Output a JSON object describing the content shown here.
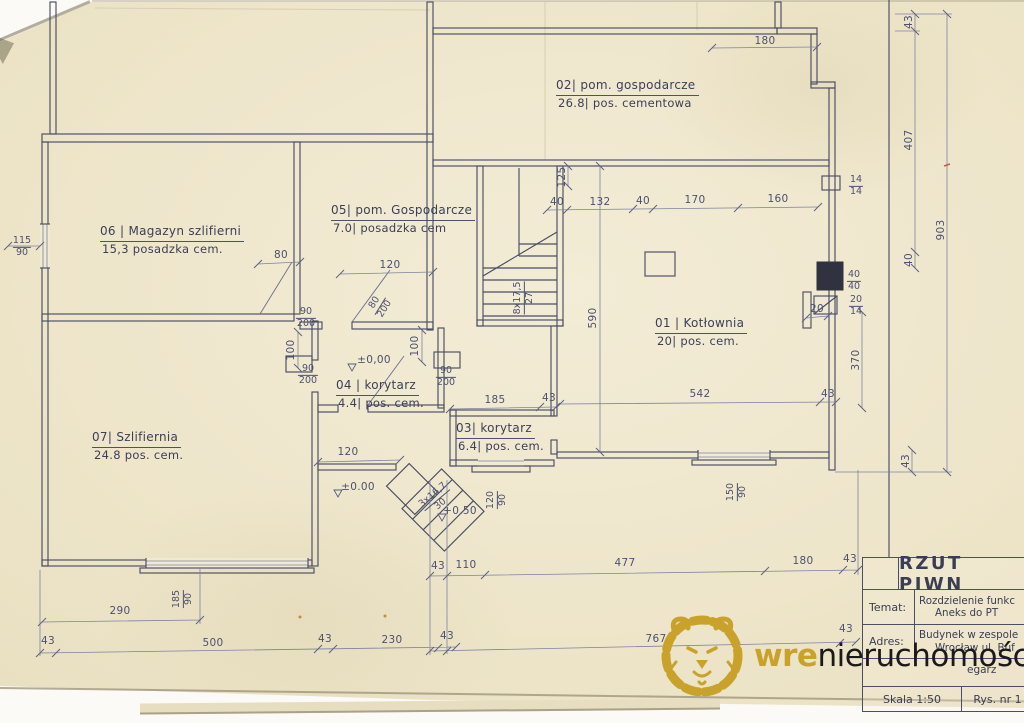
{
  "colors": {
    "paper": "#ece3c6",
    "ink": "#3e4257",
    "dimension_ink": "#4c5170",
    "accent_gold": "#C9A22C",
    "chimney_fill": "#30323f"
  },
  "watermark": {
    "brand_bold": "wre",
    "brand_rest": "nieruchomości",
    "lion_icon": "lion-head-line-art"
  },
  "title_block": {
    "drawing_title": "RZUT PIWN",
    "temat_label": "Temat:",
    "temat_line1": "Rozdzielenie funkc",
    "temat_line2": "Aneks do PT",
    "adres_label": "Adres:",
    "adres_line1": "Budynek w zespole",
    "adres_line2": "Wrocław ul. Buf",
    "partial_row_text": "egarz",
    "scale_text": "Skala 1:50",
    "drawing_number": "Rys. nr 1"
  },
  "plan": {
    "rooms": [
      {
        "id": "02|",
        "name": "pom. gospodarcze",
        "area": "26.8|",
        "floor": "pos. cementowa",
        "x": 556,
        "y": 78
      },
      {
        "id": "06 |",
        "name": "Magazyn szlifierni",
        "area": "15,3",
        "floor": "posadzka cem.",
        "x": 100,
        "y": 224
      },
      {
        "id": "05|",
        "name": "pom. Gospodarcze",
        "area": "7.0|",
        "floor": "posadzka cem",
        "x": 331,
        "y": 203
      },
      {
        "id": "01 |",
        "name": "Kotłownia",
        "area": "20|",
        "floor": "pos. cem.",
        "x": 655,
        "y": 316
      },
      {
        "id": "07|",
        "name": "Szlifiernia",
        "area": "24.8",
        "floor": "pos. cem.",
        "x": 92,
        "y": 430
      },
      {
        "id": "04 |",
        "name": "korytarz",
        "area": "4.4|",
        "floor": "pos. cem.",
        "x": 336,
        "y": 378
      },
      {
        "id": "03|",
        "name": "korytarz",
        "area": "6.4|",
        "floor": "pos. cem.",
        "x": 456,
        "y": 421
      }
    ],
    "dim_labels": [
      {
        "t": "180",
        "x": 765,
        "y": 41
      },
      {
        "t": "43",
        "x": 909,
        "y": 22,
        "r": -90
      },
      {
        "t": "407",
        "x": 909,
        "y": 140,
        "r": -90
      },
      {
        "t": "40",
        "x": 909,
        "y": 260,
        "r": -90
      },
      {
        "t": "903",
        "x": 941,
        "y": 230,
        "r": -90
      },
      {
        "t": "370",
        "x": 856,
        "y": 360,
        "r": -90
      },
      {
        "t": "43",
        "x": 906,
        "y": 461,
        "r": -90
      },
      {
        "t": "125",
        "x": 562,
        "y": 177,
        "r": -90
      },
      {
        "t": "40",
        "x": 557,
        "y": 202
      },
      {
        "t": "132",
        "x": 600,
        "y": 202
      },
      {
        "t": "40",
        "x": 643,
        "y": 201
      },
      {
        "t": "170",
        "x": 695,
        "y": 200
      },
      {
        "t": "160",
        "x": 778,
        "y": 199
      },
      {
        "t": "590",
        "x": 593,
        "y": 318,
        "r": -90
      },
      {
        "t": "20",
        "x": 817,
        "y": 309
      },
      {
        "t": "80",
        "x": 281,
        "y": 255
      },
      {
        "t": "120",
        "x": 390,
        "y": 265
      },
      {
        "t": "100",
        "x": 291,
        "y": 350,
        "r": -90
      },
      {
        "t": "100",
        "x": 415,
        "y": 346,
        "r": -90
      },
      {
        "t": "±0,00",
        "x": 374,
        "y": 360
      },
      {
        "t": "120",
        "x": 348,
        "y": 452
      },
      {
        "t": "±0.00",
        "x": 358,
        "y": 487
      },
      {
        "t": "+0.50",
        "x": 460,
        "y": 511
      },
      {
        "t": "185",
        "x": 495,
        "y": 400
      },
      {
        "t": "43",
        "x": 549,
        "y": 398
      },
      {
        "t": "542",
        "x": 700,
        "y": 394
      },
      {
        "t": "43",
        "x": 828,
        "y": 394
      },
      {
        "t": "290",
        "x": 120,
        "y": 611
      },
      {
        "t": "43",
        "x": 48,
        "y": 641
      },
      {
        "t": "500",
        "x": 213,
        "y": 643
      },
      {
        "t": "43",
        "x": 325,
        "y": 639
      },
      {
        "t": "230",
        "x": 392,
        "y": 640
      },
      {
        "t": "43",
        "x": 447,
        "y": 636
      },
      {
        "t": "43",
        "x": 438,
        "y": 566
      },
      {
        "t": "110",
        "x": 466,
        "y": 565
      },
      {
        "t": "477",
        "x": 625,
        "y": 563
      },
      {
        "t": "180",
        "x": 803,
        "y": 561
      },
      {
        "t": "43",
        "x": 850,
        "y": 559
      },
      {
        "t": "767",
        "x": 656,
        "y": 639
      },
      {
        "t": "43",
        "x": 846,
        "y": 629
      }
    ],
    "frac_labels": [
      {
        "top": "115",
        "bottom": "90",
        "x": 22,
        "y": 247
      },
      {
        "top": "90",
        "bottom": "200",
        "x": 306,
        "y": 318
      },
      {
        "top": "90",
        "bottom": "200",
        "x": 308,
        "y": 375
      },
      {
        "top": "90",
        "bottom": "200",
        "x": 446,
        "y": 377
      },
      {
        "top": "80",
        "bottom": "200",
        "x": 380,
        "y": 306,
        "r": -58
      },
      {
        "top": "8x17,5",
        "bottom": "27",
        "x": 524,
        "y": 298,
        "r": -90
      },
      {
        "top": "185",
        "bottom": "90",
        "x": 183,
        "y": 599,
        "r": -90
      },
      {
        "top": "150",
        "bottom": "90",
        "x": 737,
        "y": 492,
        "r": -90
      },
      {
        "top": "120",
        "bottom": "90",
        "x": 497,
        "y": 500,
        "r": -90
      },
      {
        "top": "14",
        "bottom": "14",
        "x": 856,
        "y": 186
      },
      {
        "top": "40",
        "bottom": "40",
        "x": 854,
        "y": 281
      },
      {
        "top": "20",
        "bottom": "14",
        "x": 856,
        "y": 306
      },
      {
        "top": "3x16,7",
        "bottom": "30",
        "x": 437,
        "y": 500,
        "r": -40
      }
    ]
  }
}
